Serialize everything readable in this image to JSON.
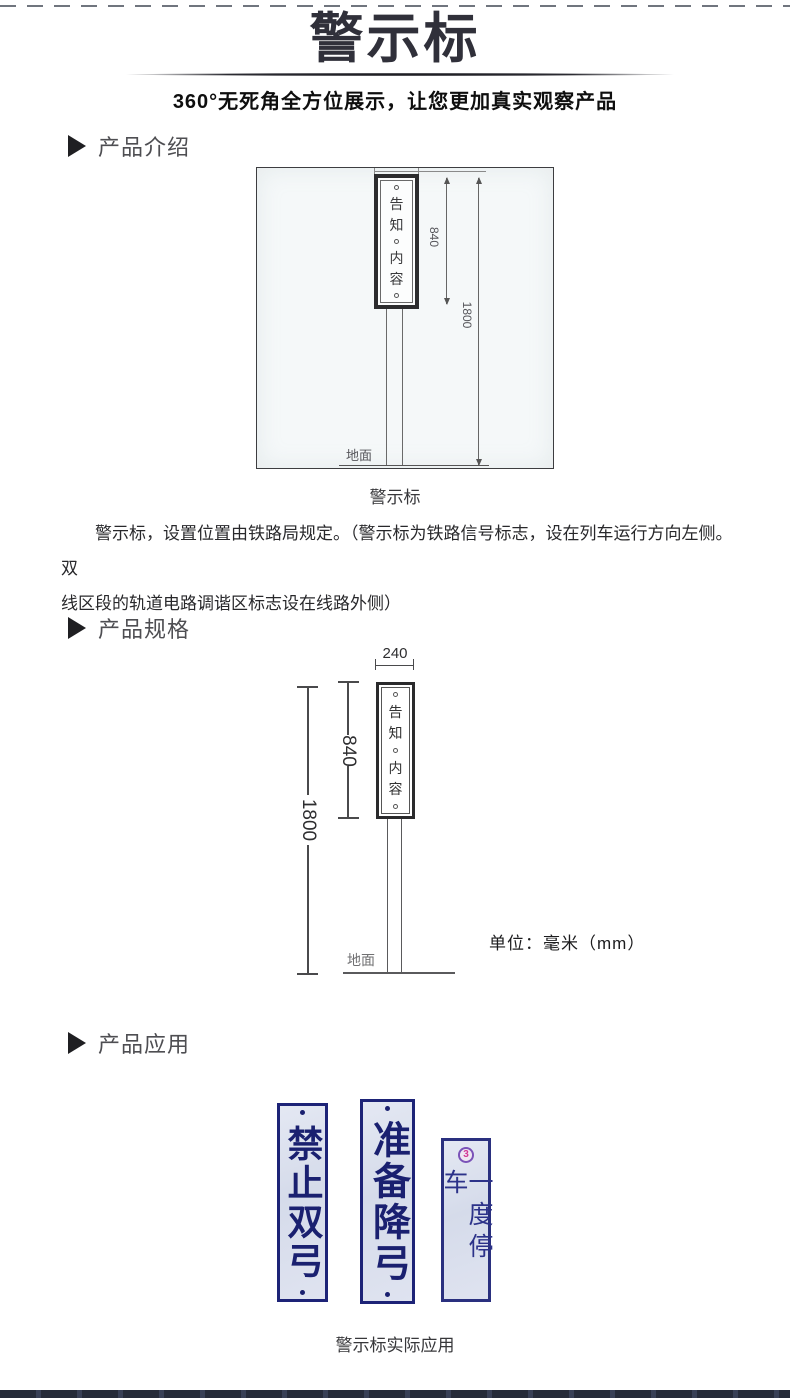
{
  "header": {
    "title": "警示标",
    "subtitle": "360°无死角全方位展示，让您更加真实观察产品"
  },
  "sections": {
    "intro": {
      "label": "产品介绍"
    },
    "spec": {
      "label": "产品规格"
    },
    "app": {
      "label": "产品应用"
    }
  },
  "drawing1": {
    "plate_chars": [
      "告",
      "知",
      "内",
      "容"
    ],
    "dims": {
      "sign_height": "840",
      "total_height": "1800"
    },
    "ground_label": "地面",
    "caption": "警示标"
  },
  "paragraph": {
    "line1": "警示标，设置位置由铁路局规定。（警示标为铁路信号标志，设在列车运行方向左侧。双",
    "line2": "线区段的轨道电路调谐区标志设在线路外侧）"
  },
  "drawing2": {
    "plate_chars": [
      "告",
      "知",
      "内",
      "容"
    ],
    "dims": {
      "width": "240",
      "sign_height": "840",
      "total_height": "1800"
    },
    "ground_label": "地面",
    "unit_label": "单位：毫米（mm）"
  },
  "application": {
    "signs": [
      {
        "text": "禁止双弓"
      },
      {
        "text": "准备降弓"
      },
      {
        "text": "一度停车",
        "badge": "3"
      }
    ],
    "caption": "警示标实际应用"
  },
  "colors": {
    "title": "#30303a",
    "sign_border_navy": "#1d2377",
    "sign_text_navy": "#1a2070",
    "sign_background": "#dde2ef",
    "badge_ring_violet": "#7a52b8",
    "badge_text_pink": "#d23795",
    "bottom_bar": "#262b39",
    "paper": "#f5f8f9"
  }
}
